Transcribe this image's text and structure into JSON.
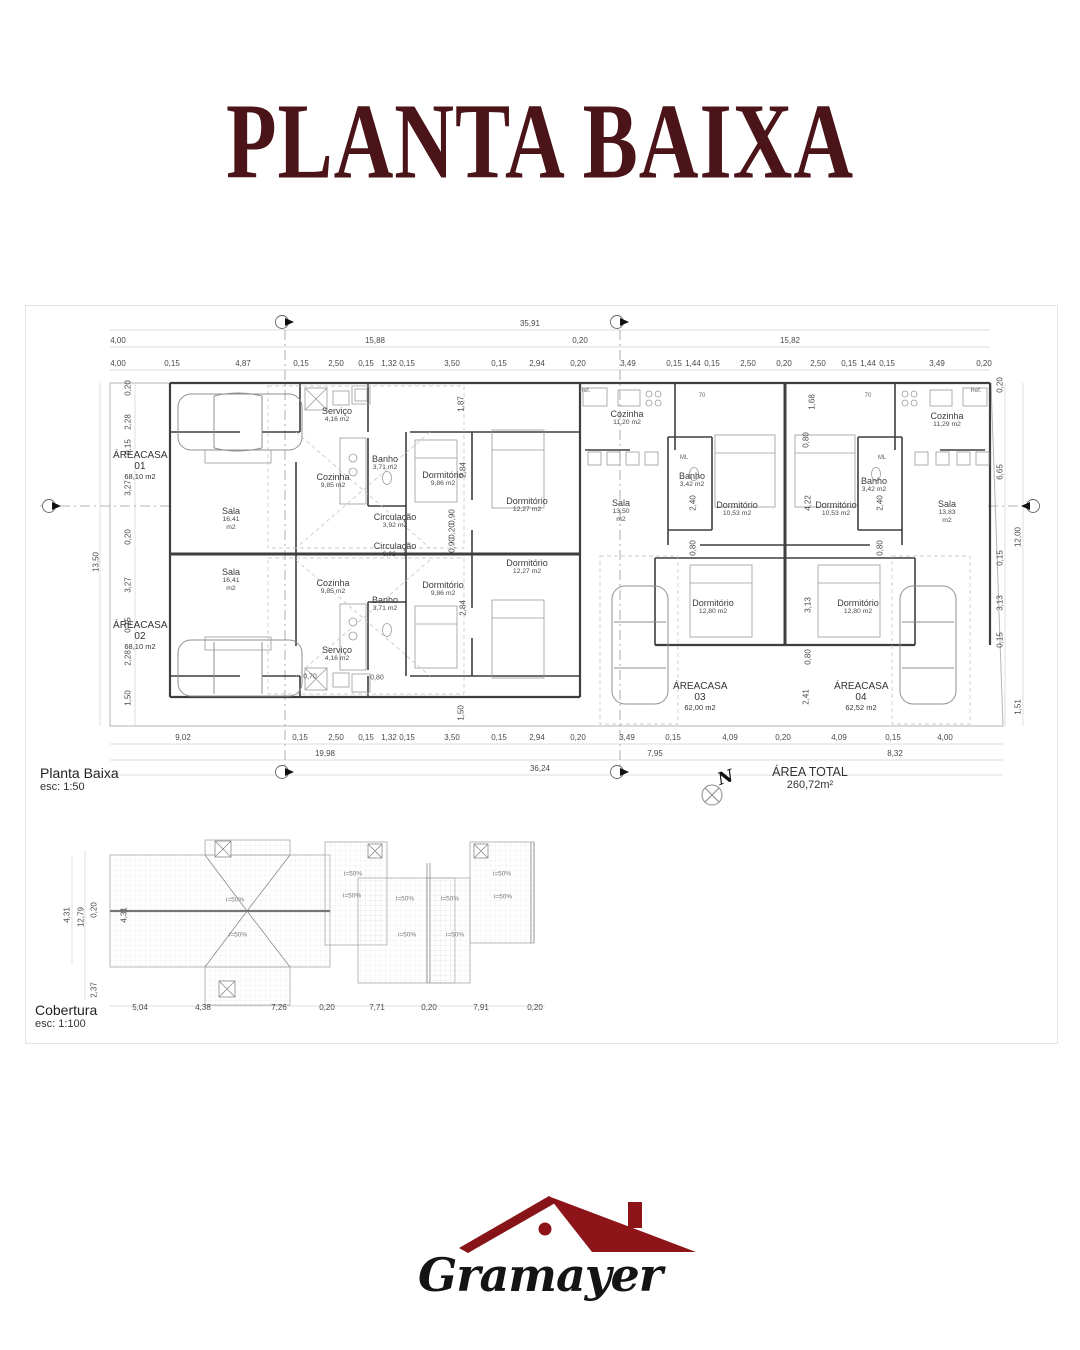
{
  "title": "PLANTA BAIXA",
  "plan": {
    "name": "Planta Baixa",
    "scale": "esc: 1:50",
    "area_total": {
      "label": "ÁREA TOTAL",
      "value": "260,72m²"
    },
    "north": "N",
    "houses": [
      {
        "name": "ÁREACASA 01",
        "area": "68,10 m2"
      },
      {
        "name": "ÁREACASA 02",
        "area": "68,10 m2"
      },
      {
        "name": "ÁREACASA 03",
        "area": "62,00 m2"
      },
      {
        "name": "ÁREACASA 04",
        "area": "62,52 m2"
      }
    ],
    "rooms": [
      {
        "name": "Serviço",
        "area": "4,16 m2"
      },
      {
        "name": "Sala",
        "area": "16,41 m2"
      },
      {
        "name": "Cozinha",
        "area": "9,85 m2"
      },
      {
        "name": "Banho",
        "area": "3,71 m2"
      },
      {
        "name": "Circulação",
        "area": "3,92 m2"
      },
      {
        "name": "Dormitório",
        "area": "9,86 m2"
      },
      {
        "name": "Dormitório",
        "area": "12,27 m2"
      },
      {
        "name": "Circulação",
        "area": "3,92 m2"
      },
      {
        "name": "Dormitório",
        "area": "12,27 m2"
      },
      {
        "name": "Dormitório",
        "area": "9,86 m2"
      },
      {
        "name": "Sala",
        "area": "16,41 m2"
      },
      {
        "name": "Cozinha",
        "area": "9,85 m2"
      },
      {
        "name": "Banho",
        "area": "3,71 m2"
      },
      {
        "name": "Serviço",
        "area": "4,16 m2"
      },
      {
        "name": "Cozinha",
        "area": "11,20 m2"
      },
      {
        "name": "Sala",
        "area": "13,50 m2"
      },
      {
        "name": "Banho",
        "area": "3,42 m2"
      },
      {
        "name": "Dormitório",
        "area": "10,53 m2"
      },
      {
        "name": "Dormitório",
        "area": "12,80 m2"
      },
      {
        "name": "Cozinha",
        "area": "11,29 m2"
      },
      {
        "name": "Sala",
        "area": "13,83 m2"
      },
      {
        "name": "Banho",
        "area": "3,42 m2"
      },
      {
        "name": "Dormitório",
        "area": "10,53 m2"
      },
      {
        "name": "Dormitório",
        "area": "12,80 m2"
      }
    ],
    "dims": {
      "top1": [
        "35,91"
      ],
      "top2": [
        "4,00",
        "15,88",
        "0,20",
        "15,82"
      ],
      "top3": [
        "4,00",
        "0,15",
        "4,87",
        "0,15",
        "2,50",
        "0,15",
        "1,32",
        "0,15",
        "3,50",
        "0,15",
        "2,94",
        "0,20",
        "3,49",
        "0,15",
        "1,44",
        "0,15",
        "2,50",
        "0,20",
        "2,50",
        "0,15",
        "1,44",
        "0,15",
        "3,49",
        "0,20"
      ],
      "bottom1": [
        "9,02",
        "0,15",
        "2,50",
        "0,15",
        "1,32",
        "0,15",
        "3,50",
        "0,15",
        "2,94",
        "0,20",
        "3,49",
        "0,15",
        "4,09",
        "0,20",
        "4,09",
        "0,15",
        "4,00"
      ],
      "bottom2": [
        "19,98",
        "7,95",
        "8,32"
      ],
      "bottom3": [
        "36,24"
      ],
      "left": [
        "0,20",
        "2,28",
        "0,15",
        "3,27",
        "0,20",
        "3,27",
        "0,15",
        "2,28",
        "1,50"
      ],
      "left_total": "13,50",
      "right_inner": [
        "0,20",
        "6,65",
        "0,15",
        "3,13",
        "0,15"
      ],
      "right_outer": [
        "12,00",
        "1,51"
      ],
      "inner": [
        "1,87",
        "1,68",
        "0,80",
        "2,84",
        "0,90",
        "0,20",
        "0,90",
        "2,84",
        "1,50",
        "2,40",
        "4,22",
        "2,40",
        "0,80",
        "0,80",
        "3,13",
        "0,80",
        "2,41"
      ],
      "small": [
        "0,70",
        "0,80"
      ]
    },
    "misc": [
      "Ref.",
      "Ref.",
      "70",
      "70",
      "ML",
      "ML"
    ]
  },
  "roof": {
    "name": "Cobertura",
    "scale": "esc: 1:100",
    "slopes": [
      "i=50%",
      "i=50%",
      "i=50%",
      "i=50%",
      "i=50%",
      "i=50%",
      "i=50%",
      "i=50%",
      "i=50%",
      "i=50%"
    ],
    "dims_bottom": [
      "5,04",
      "4,38",
      "7,26",
      "0,20",
      "7,71",
      "0,20",
      "7,91",
      "0,20"
    ],
    "dims_left": [
      "4,31",
      "12,79",
      "0,20",
      "2,37"
    ],
    "ridge_dim": "4,31"
  },
  "logo": {
    "text": "Gramayer"
  },
  "colors": {
    "title": "#4a1418",
    "logo_red": "#8d1519",
    "walls": "#3e3e3e"
  }
}
